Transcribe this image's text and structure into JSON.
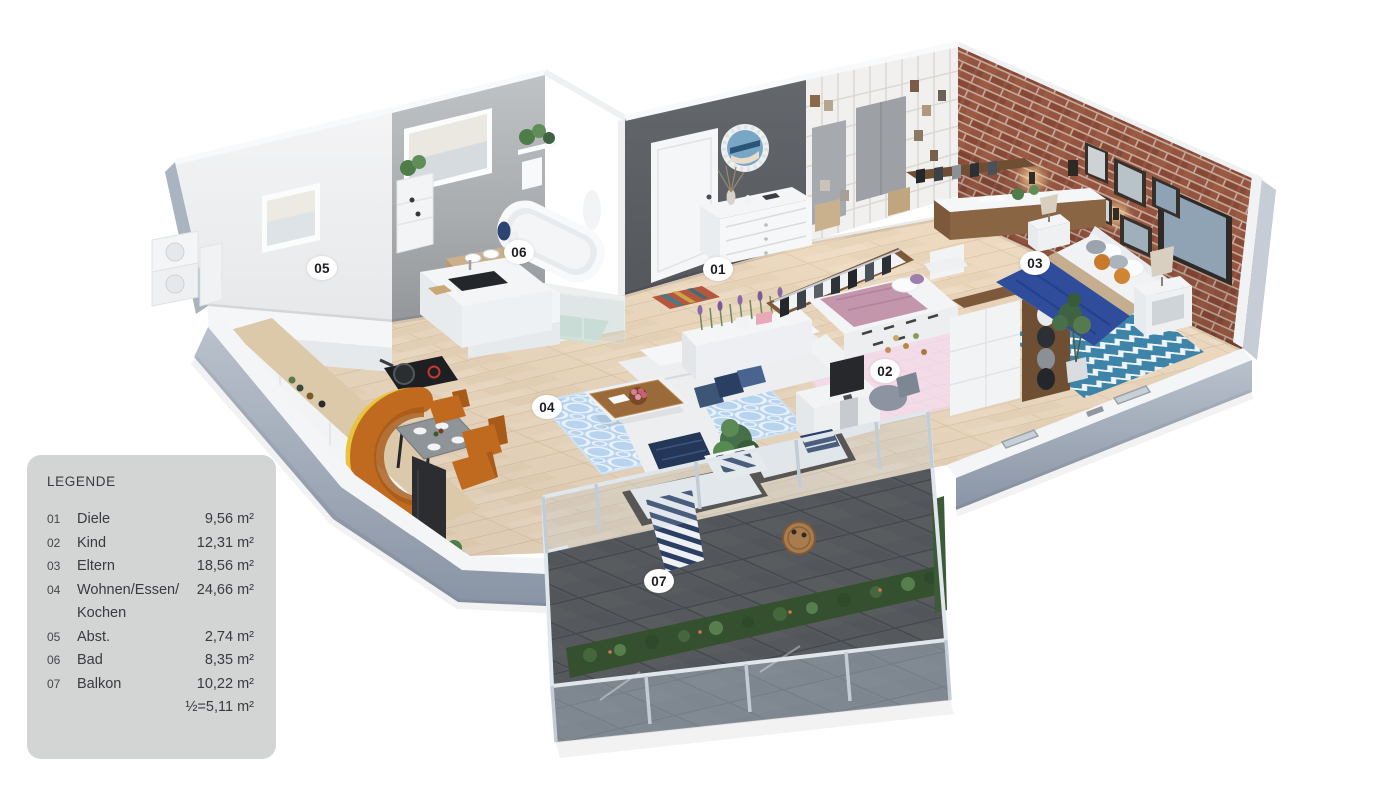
{
  "page": {
    "background": "#ffffff",
    "type": "3d-apartment-floor-plan-rendering"
  },
  "legend": {
    "title": "LEGENDE",
    "colors": {
      "background": "#d3d4d4",
      "text": "#3a3a3f"
    },
    "rows": [
      {
        "number": "01",
        "name": "Diele",
        "area": "9,56 m²"
      },
      {
        "number": "02",
        "name": "Kind",
        "area": "12,31 m²"
      },
      {
        "number": "03",
        "name": "Eltern",
        "area": "18,56 m²"
      },
      {
        "number": "04",
        "name": "Wohnen/Essen/\nKochen",
        "area": "24,66 m²"
      },
      {
        "number": "05",
        "name": "Abst.",
        "area": "2,74 m²"
      },
      {
        "number": "06",
        "name": "Bad",
        "area": "8,35 m²"
      },
      {
        "number": "07",
        "name": "Balkon",
        "area": "10,22 m²"
      },
      {
        "number": "",
        "name": "",
        "area": "½=5,11 m²"
      }
    ]
  },
  "floorplan": {
    "description": "Isometric 3D rendering of an apartment with balcony",
    "room_labels": [
      {
        "id": "01",
        "room": "Diele",
        "x": 718,
        "y": 269
      },
      {
        "id": "02",
        "room": "Kind",
        "x": 885,
        "y": 371
      },
      {
        "id": "03",
        "room": "Eltern",
        "x": 1035,
        "y": 263
      },
      {
        "id": "04",
        "room": "Wohnen/Essen/Kochen",
        "x": 547,
        "y": 407
      },
      {
        "id": "05",
        "room": "Abst.",
        "x": 322,
        "y": 268
      },
      {
        "id": "06",
        "room": "Bad",
        "x": 519,
        "y": 252
      },
      {
        "id": "07",
        "room": "Balkon",
        "x": 659,
        "y": 581
      }
    ],
    "palette": {
      "wood_floor": "#ecd9c0",
      "balcony_tiles": "#55585c",
      "brick_wall": "#95543f",
      "entry_wall": "#5e6266",
      "concrete_wall": "#a9acaf",
      "white_walls": "#f2f3f5",
      "outer_wall_face": "#8a95a6",
      "glass_railing": "#b9cbd8",
      "accent_sofa_orange": "#bf6a1f",
      "bed_blanket_blue": "#2f4d9b",
      "kid_rug_pink": "#f3dce8",
      "parent_rug_blue": "#3e84a8",
      "living_rug_blue": "#b7d3ee"
    }
  }
}
